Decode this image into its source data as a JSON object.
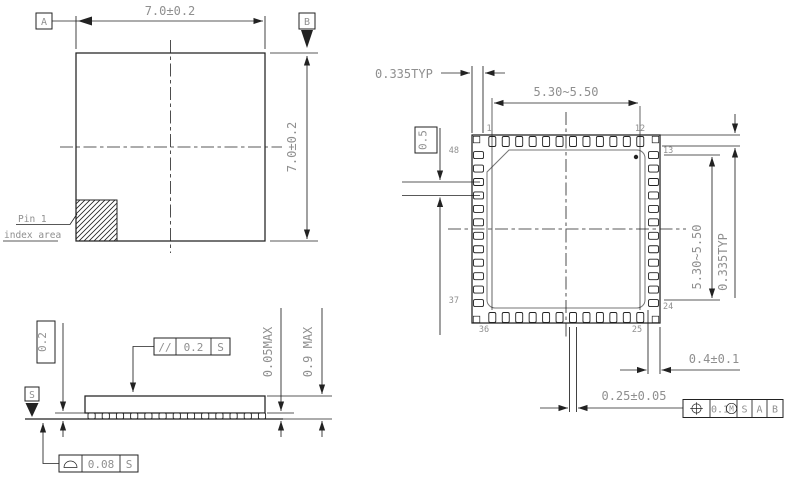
{
  "colors": {
    "line": "#222222",
    "dim_text": "#8f8f8f",
    "background": "#ffffff",
    "pad_outline": "#757575"
  },
  "top_view": {
    "datum_a": "A",
    "datum_b": "B",
    "dim_width": "7.0±0.2",
    "dim_height": "7.0±0.2",
    "pin1_note_line1": "Pin 1",
    "pin1_note_line2": "index area"
  },
  "side_view": {
    "dim_standoff_basic": "0.2",
    "parallelism": {
      "symbol": "//",
      "value": "0.2",
      "datum": "S"
    },
    "dim_standoff_max": "0.05MAX",
    "dim_height_max": "0.9 MAX",
    "seating_datum": "S",
    "coplanarity": {
      "value": "0.08",
      "datum": "S"
    }
  },
  "bottom_view": {
    "dim_edge_pitch_top": "0.335TYP",
    "dim_span_top": "5.30~5.50",
    "dim_pitch_basic": "0.5",
    "dim_span_right": "5.30~5.50",
    "dim_edge_pitch_right": "0.335TYP",
    "dim_lead_width": "0.25±0.05",
    "dim_lead_length": "0.4±0.1",
    "position_fcf": {
      "tolerance": "0.1",
      "modifier": "M",
      "datum_1": "S",
      "datum_2": "A",
      "datum_3": "B"
    },
    "pins": {
      "p1": "1",
      "p12": "12",
      "p13": "13",
      "p24": "24",
      "p25": "25",
      "p36": "36",
      "p37": "37",
      "p48": "48"
    }
  }
}
